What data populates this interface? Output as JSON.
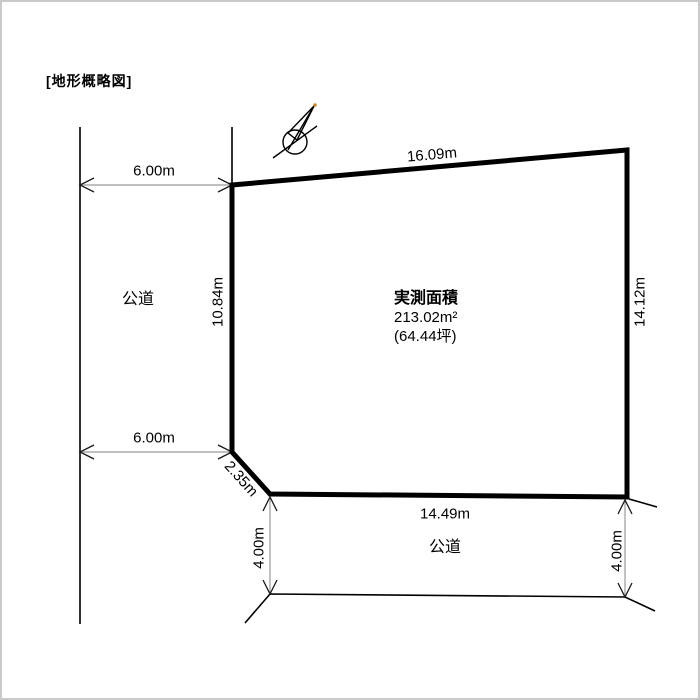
{
  "page": {
    "title": "[地形概略図]"
  },
  "plot": {
    "area_label": "実測面積",
    "area_sqm": "213.02m²",
    "area_tsubo": "(64.44坪)",
    "edges": {
      "top": "16.09m",
      "left": "10.84m",
      "right": "14.12m",
      "bottom": "14.49m",
      "corner_cut": "2.35m"
    }
  },
  "roads": {
    "west": {
      "label": "公道",
      "width_top": "6.00m",
      "width_bottom": "6.00m"
    },
    "south": {
      "label": "公道",
      "width_left": "4.00m",
      "width_right": "4.00m"
    }
  },
  "icons": {
    "north_arrow": "north-arrow"
  },
  "colors": {
    "outline": "#000000",
    "dim_line": "#999999",
    "arrowhead": "#1a1a1a",
    "frame_border": "#c9c9c9",
    "north_tip": "#cc8822"
  }
}
